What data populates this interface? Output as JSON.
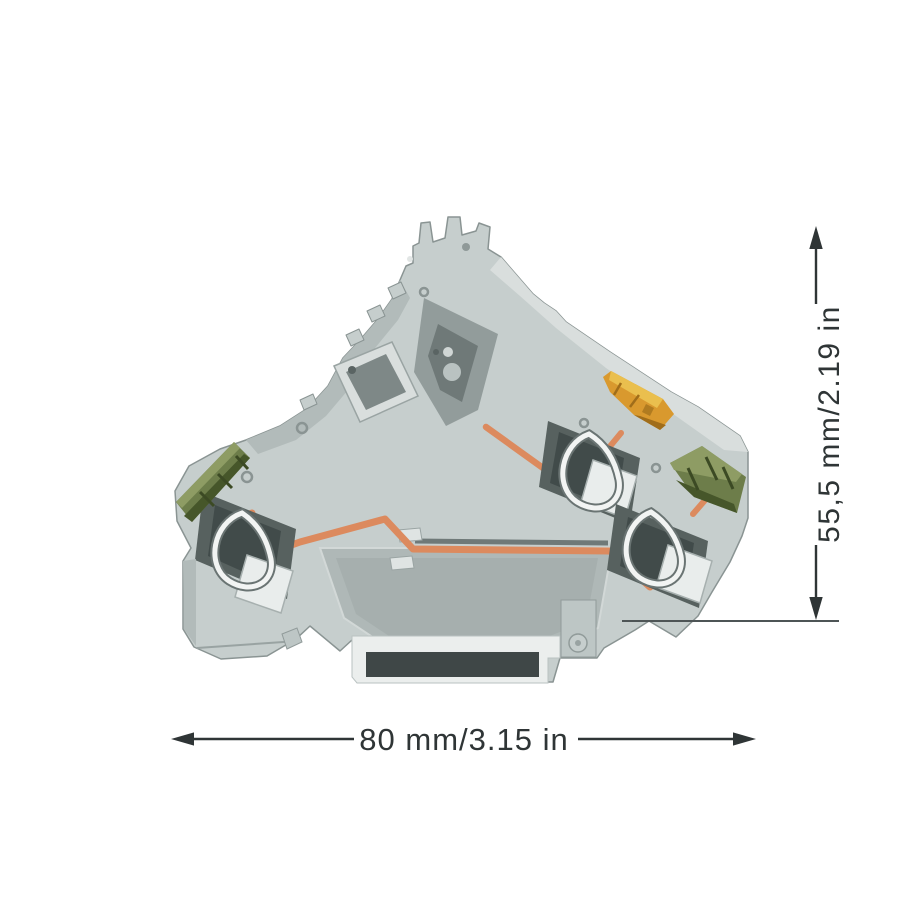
{
  "figure": {
    "type": "product-dimension-diagram",
    "subject": "multi-level din-rail terminal block, side view",
    "height_dimension_label": "55,5 mm/2.19 in",
    "width_dimension_label": "80 mm/3.15 in"
  },
  "icons": {
    "up_arrow": "dimension-arrow-up",
    "down_arrow": "dimension-arrow-down",
    "left_arrow": "dimension-arrow-left",
    "right_arrow": "dimension-arrow-right"
  },
  "colors": {
    "background": "#ffffff",
    "dimension_line": "#2f3536",
    "extension_line": "#4e5556",
    "body_gray": "#c6cecd",
    "body_highlight": "#d9dedd",
    "body_shadow": "#b2bbba",
    "panel_gray": "#afb8b7",
    "edge_gray": "#8a9493",
    "cavity_dark": "#57615f",
    "cavity_deep": "#414b4a",
    "clamp_silver": "#e9edec",
    "spring_white": "#f2f4f3",
    "spring_under": "#6a7473",
    "conductor_copper": "#dc8a5e",
    "lever_orange": "#d9992e",
    "lever_highlight": "#eabf4e",
    "lever_shade": "#a06d1a",
    "ground_green": "#6d7d4a",
    "ground_green_dark": "#46562a",
    "ground_green_light": "#8e9c64",
    "rail_dark": "#3f4747"
  }
}
